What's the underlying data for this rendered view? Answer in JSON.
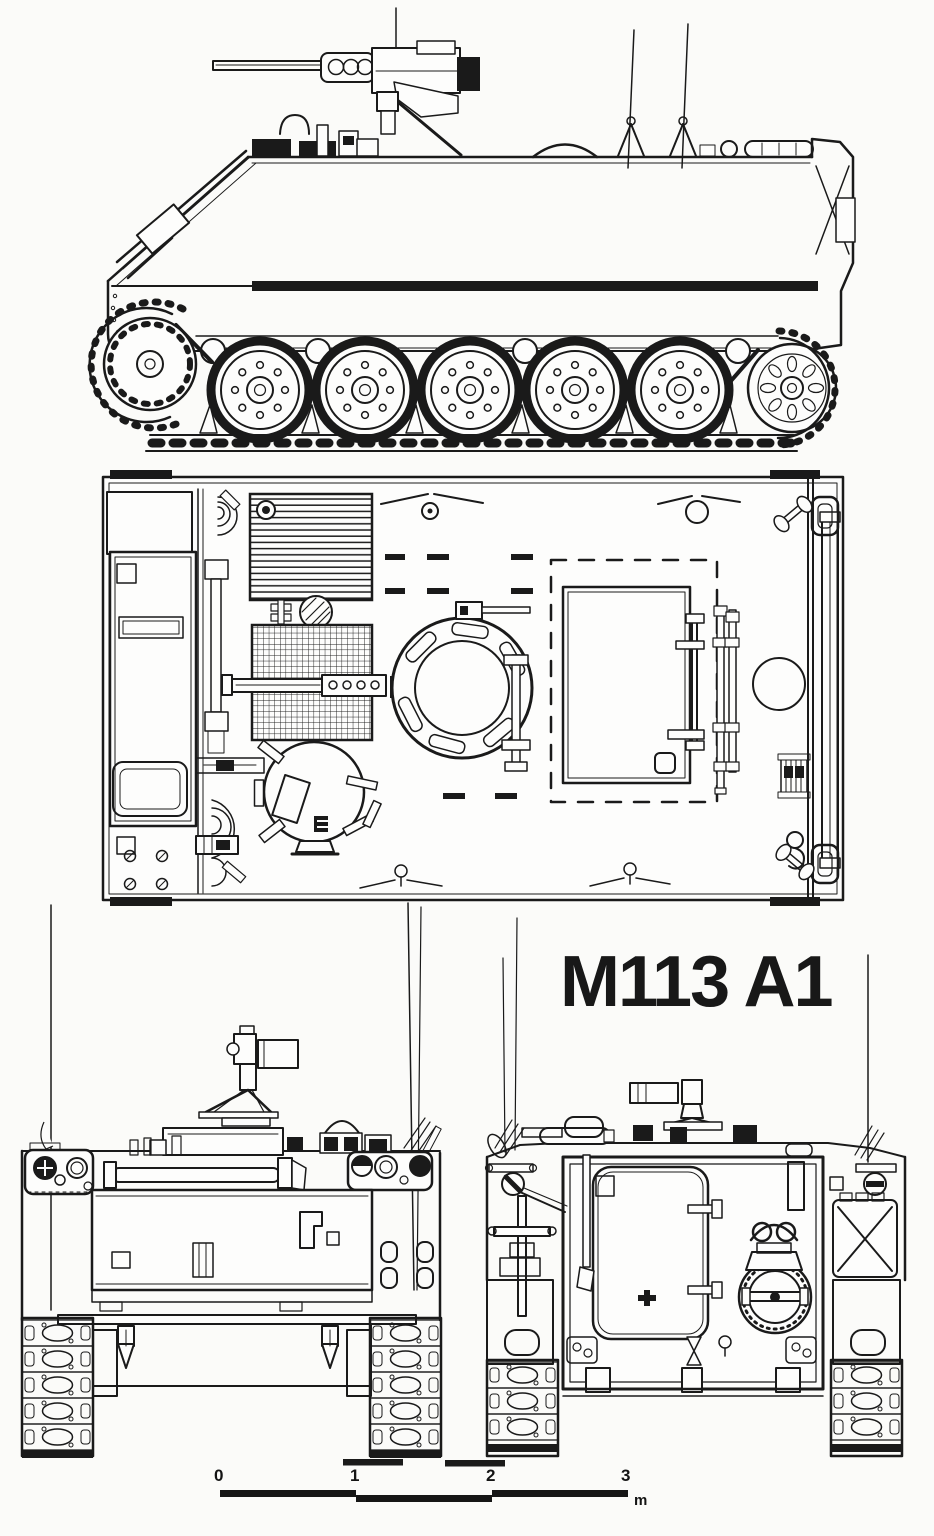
{
  "title": "M113 A1",
  "scale_bar": {
    "tick_labels": [
      "0",
      "1",
      "2",
      "3"
    ],
    "unit_label": "m"
  },
  "colors": {
    "ink": "#1a1a1a",
    "paper": "#fbfbf9"
  }
}
